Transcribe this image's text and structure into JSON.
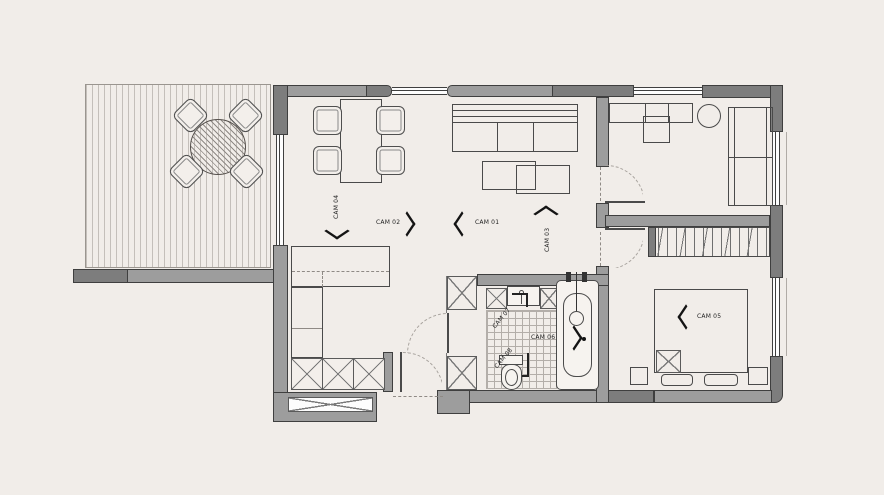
{
  "title": "Apartment floor plan with camera view markers",
  "palette": {
    "background": "#f1ede9",
    "wall_fill": "#9d9d9d",
    "wall_dark_fill": "#7d7d7d",
    "wall_outline": "#3f3f3f",
    "furniture_line": "#4a4a4a",
    "label_text": "#1f1f1f",
    "deck_stripe": "#c4bfba",
    "tile_line": "#b3aea9",
    "dashed_swing": "#a8a39e"
  },
  "markers": [
    {
      "id": "cam-01",
      "label": "CAM 01",
      "direction": "left"
    },
    {
      "id": "cam-02",
      "label": "CAM 02",
      "direction": "right"
    },
    {
      "id": "cam-03",
      "label": "CAM 03",
      "direction": "up"
    },
    {
      "id": "cam-04",
      "label": "CAM 04",
      "direction": "down"
    },
    {
      "id": "cam-05",
      "label": "CAM 05",
      "direction": "left"
    },
    {
      "id": "cam-06",
      "label": "CAM 06",
      "direction": "right"
    },
    {
      "id": "cam-07",
      "label": "CAM 07",
      "direction": "diagonal"
    },
    {
      "id": "cam-08",
      "label": "CAM 08",
      "direction": "diagonal"
    }
  ]
}
